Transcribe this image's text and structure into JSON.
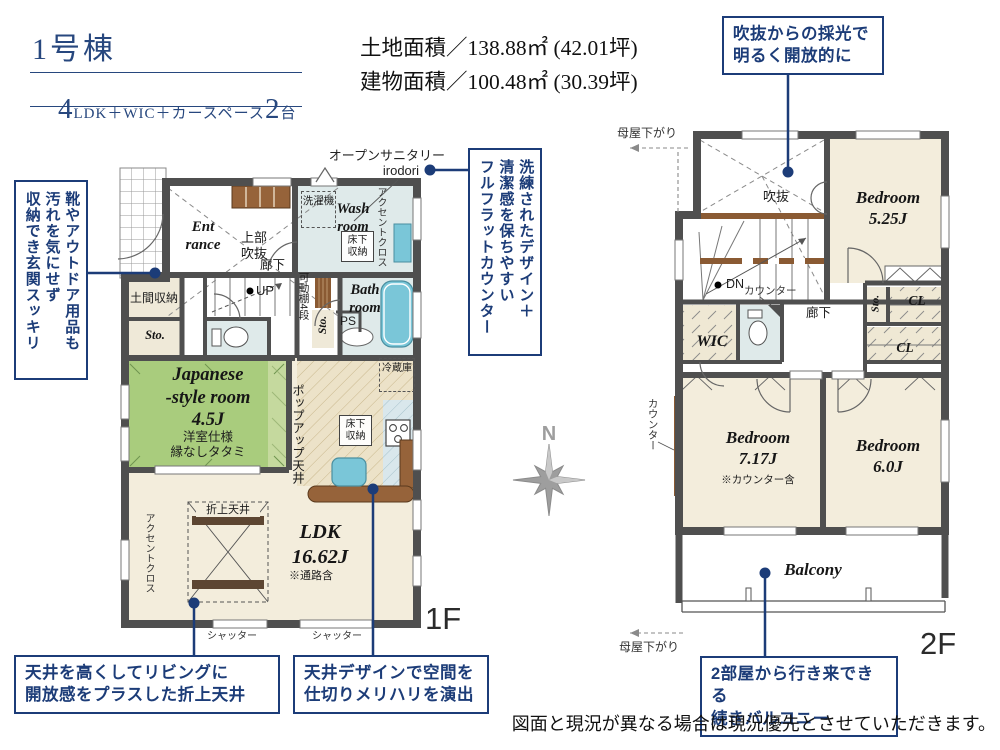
{
  "header": {
    "building_no": "1号棟",
    "spec": [
      "4",
      "LDK＋WIC＋カースペース",
      "2",
      "台"
    ],
    "land_area": "土地面積／138.88㎡ (42.01坪)",
    "building_area": "建物面積／100.48㎡ (30.39坪)"
  },
  "callouts": {
    "void_light": "吹抜からの採光で\n明るく開放的に",
    "entrance_storage": [
      "靴やアウトドア用品も",
      "汚れを気にせず",
      "収納でき玄関スッキリ"
    ],
    "flat_counter": [
      "洗練されたデザイン＋",
      "清潔感を保ちやすい",
      "フルフラットカウンター"
    ],
    "folded_ceiling": "天井を高くしてリビングに\n開放感をプラスした折上天井",
    "ceiling_design": "天井デザインで空間を\n仕切りメリハリを演出",
    "balcony": "2部屋から行き来できる\n続きバルコニー"
  },
  "plan1f": {
    "open_sanitary": "オープンサニタリー",
    "irodori": "irodori",
    "entrance": "Ent\nrance",
    "upper_void": "上部\n吹抜",
    "washing_machine": "洗濯機",
    "wash_room": "Wash\nroom",
    "underfloor_wash": "床下\n収納",
    "accent_cloth_wash": "アクセントクロス",
    "doma_storage": "土間収納",
    "hallway": "廊下",
    "up": "UP",
    "movable_shelf": "可動棚4段",
    "sto_left": "Sto.",
    "sto_mid": "Sto.",
    "ps": "PS",
    "bath": "Bath\nroom",
    "japanese_room": "Japanese\n-style room\n4.5J",
    "japanese_note": "洋室仕様\n縁なしタタミ",
    "popup_ceiling": "ポップアップ天井",
    "fridge": "冷蔵庫",
    "underfloor_kitchen": "床下\n収納",
    "folded_ceiling": "折上天井",
    "ldk": "LDK\n16.62J",
    "ldk_note": "※通路含",
    "accent_cloth_ldk": "アクセントクロス",
    "shutter_1": "シャッター",
    "shutter_2": "シャッター",
    "floor_label": "1F"
  },
  "plan2f": {
    "moya_top": "母屋下がり",
    "void": "吹抜",
    "bedroom_525": "Bedroom\n5.25J",
    "dn": "DN",
    "counter_top": "カウンター",
    "wic": "WIC",
    "hallway": "廊下",
    "sto": "Sto.",
    "cl_1": "CL",
    "cl_2": "CL",
    "counter_left": "カウンター",
    "bedroom_717": "Bedroom\n7.17J",
    "bedroom_717_note": "※カウンター含",
    "bedroom_60": "Bedroom\n6.0J",
    "balcony": "Balcony",
    "moya_bottom": "母屋下がり",
    "floor_label": "2F"
  },
  "compass": {
    "north": "N"
  },
  "disclaimer": "図面と現況が異なる場合は現況優先とさせていただきます。",
  "colors": {
    "accent_navy": "#1c3c78",
    "wall_gray": "#4f4f4f",
    "tatami_green": "#a9cc7d",
    "water_blue": "#7ac6d8",
    "room_beige": "#f3eddc",
    "wood_brown": "#8a5a33",
    "compass_gray": "#9e9e9e"
  }
}
